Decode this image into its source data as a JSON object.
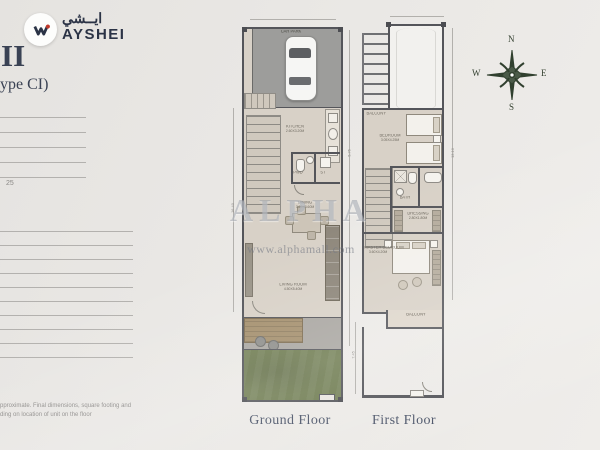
{
  "brand": {
    "name_ar": "ايــشي",
    "name_en": "AYSHEI"
  },
  "heading": {
    "title": "II",
    "type_line": "ype CI)"
  },
  "sidebar": {
    "note": "25",
    "disclaimer_line1": "pproximate. Final dimensions, square footing and",
    "disclaimer_line2": "ding on location of unit on the floor"
  },
  "watermark": {
    "title": "ALPHA",
    "site": "www.alphamall.com"
  },
  "compass": {
    "n": "N",
    "e": "E",
    "s": "S",
    "w": "W"
  },
  "ground_floor": {
    "caption": "Ground Floor",
    "rooms": {
      "car_park": {
        "label": "CAR PARK"
      },
      "kitchen": {
        "label": "KITCHEN",
        "size": "2.60X3.20M"
      },
      "powder": {
        "label": "PWD"
      },
      "store": {
        "label": "ST"
      },
      "dining": {
        "label": "DINING",
        "size": "3.20X3.60M"
      },
      "living": {
        "label": "LIVING ROOM",
        "size": "4.50X5.40M"
      }
    },
    "dims": {
      "left": "16.40",
      "right": "5.75"
    }
  },
  "first_floor": {
    "caption": "First Floor",
    "rooms": {
      "front_balcony": {
        "label": "BALCONY"
      },
      "bedroom": {
        "label": "BEDROOM",
        "size": "3.05X4.25M"
      },
      "bath": {
        "label": "BATH"
      },
      "dressing": {
        "label": "DRESSING",
        "size": "2.80X1.80M"
      },
      "master": {
        "label": "MASTER BEDROOM",
        "size": "3.60X4.20M"
      },
      "balcony": {
        "label": "BALCONY"
      }
    },
    "dims": {
      "left": "7.45",
      "right": "13.10"
    }
  }
}
